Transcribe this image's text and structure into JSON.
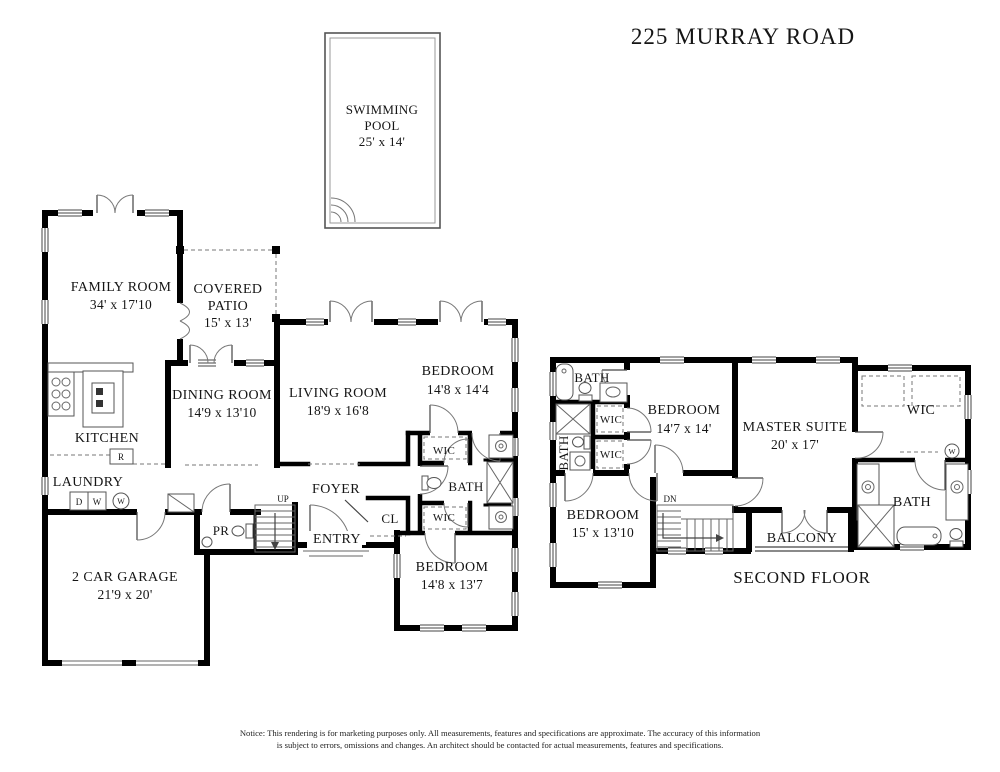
{
  "title": "225 MURRAY ROAD",
  "pool": {
    "name_line1": "SWIMMING",
    "name_line2": "POOL",
    "dims": "25' x 14'"
  },
  "first_floor": {
    "family_room": {
      "name": "FAMILY ROOM",
      "dims": "34' x 17'10"
    },
    "covered_patio": {
      "name_line1": "COVERED",
      "name_line2": "PATIO",
      "dims": "15' x 13'"
    },
    "kitchen": {
      "name": "KITCHEN"
    },
    "dining_room": {
      "name": "DINING ROOM",
      "dims": "14'9 x 13'10"
    },
    "living_room": {
      "name": "LIVING ROOM",
      "dims": "18'9 x 16'8"
    },
    "bedroom_rear": {
      "name": "BEDROOM",
      "dims": "14'8 x 14'4"
    },
    "bedroom_front": {
      "name": "BEDROOM",
      "dims": "14'8 x 13'7"
    },
    "bath": {
      "name": "BATH"
    },
    "wic_top": {
      "name": "WIC"
    },
    "wic_bottom": {
      "name": "WIC"
    },
    "laundry": {
      "name": "LAUNDRY"
    },
    "garage": {
      "name": "2 CAR GARAGE",
      "dims": "21'9 x 20'"
    },
    "foyer": {
      "name": "FOYER"
    },
    "entry": {
      "name": "ENTRY"
    },
    "closet": {
      "name": "CL"
    },
    "powder_room": {
      "name": "PR"
    },
    "stairs": {
      "name": "UP"
    },
    "appliances": {
      "dryer": "D",
      "washer": "W",
      "water_heater": "W",
      "refrigerator": "R"
    }
  },
  "second_floor": {
    "caption": "SECOND FLOOR",
    "bath_top": {
      "name": "BATH"
    },
    "bath_left": {
      "name": "BATH"
    },
    "wic_1": {
      "name": "WIC"
    },
    "wic_2": {
      "name": "WIC"
    },
    "bedroom_rear": {
      "name": "BEDROOM",
      "dims": "14'7 x 14'"
    },
    "master_suite": {
      "name": "MASTER SUITE",
      "dims": "20' x 17'"
    },
    "master_wic": {
      "name": "WIC"
    },
    "master_bath": {
      "name": "BATH"
    },
    "bedroom_front": {
      "name": "BEDROOM",
      "dims": "15' x 13'10"
    },
    "stairs": {
      "name": "DN"
    },
    "balcony": {
      "name": "BALCONY"
    },
    "washer": "W"
  },
  "notice": {
    "line1": "Notice: This rendering is for marketing purposes only. All measurements, features and specifications are approximate. The accuracy of this information",
    "line2": "is subject to errors, omissions and changes. An architect should be contacted for actual measurements, features and specifications."
  }
}
